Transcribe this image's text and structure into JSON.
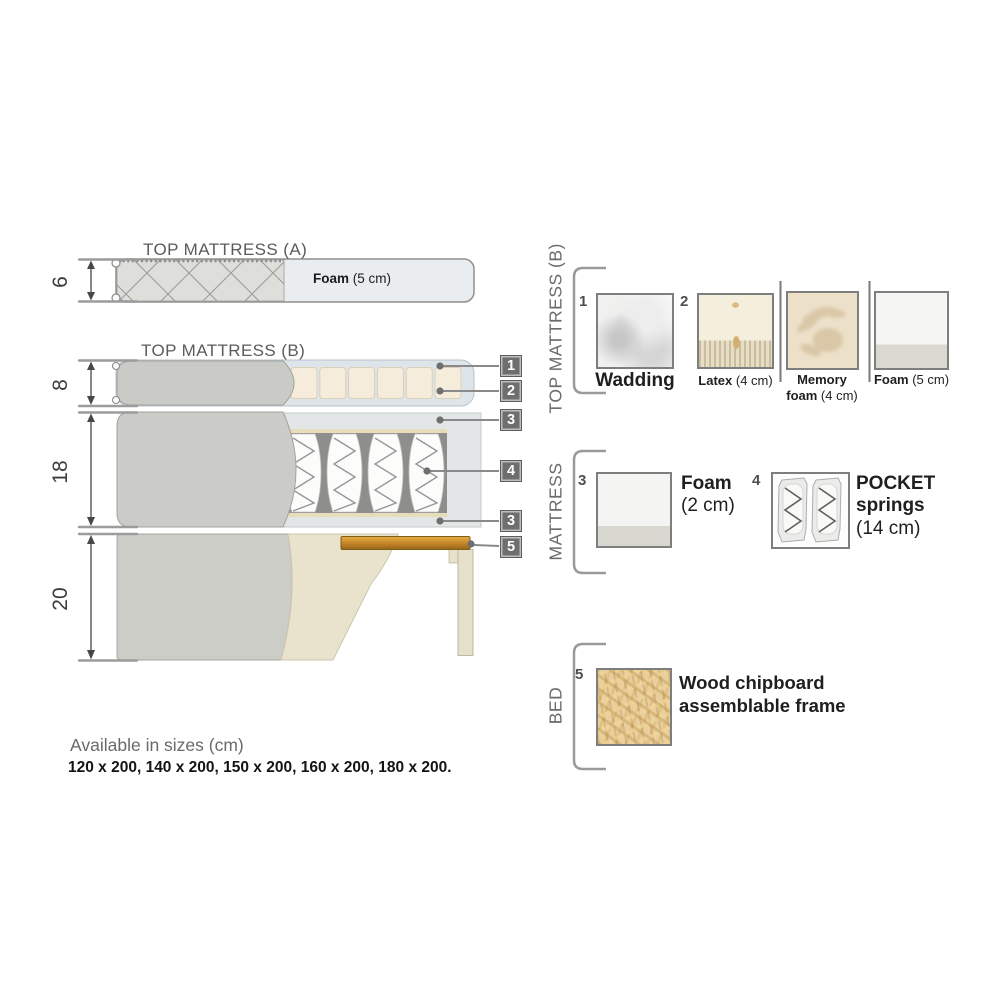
{
  "diagram": {
    "top_a": {
      "title": "TOP MATTRESS (A)"
    },
    "top_b": {
      "title": "TOP MATTRESS (B)"
    },
    "foam": {
      "bold": "Foam",
      "rest": " (5 cm)"
    },
    "dims": [
      "6",
      "8",
      "18",
      "20"
    ],
    "badges": [
      "1",
      "2",
      "3",
      "4",
      "3",
      "5"
    ]
  },
  "legend": {
    "sections": [
      {
        "label": "TOP MATTRESS (B)",
        "items": [
          {
            "num": "1",
            "bold": "Wadding",
            "rest": ""
          },
          {
            "num": "2",
            "bold": "Latex",
            "rest": " (4 cm)"
          },
          {
            "bold": "Memory foam",
            "rest": " (4 cm)"
          },
          {
            "bold": "Foam",
            "rest": " (5 cm)"
          }
        ]
      },
      {
        "label": "MATTRESS",
        "items": [
          {
            "num": "3",
            "bold": "Foam",
            "rest": "(2 cm)"
          },
          {
            "num": "4",
            "bold": "POCKET springs",
            "rest": "(14 cm)"
          }
        ]
      },
      {
        "label": "BED",
        "items": [
          {
            "num": "5",
            "bold": "Wood chipboard assemblable frame",
            "rest": ""
          }
        ]
      }
    ]
  },
  "footer": {
    "title": "Available in sizes (cm)",
    "sizes": "120 x 200, 140 x 200, 150 x 200, 160 x 200, 180 x 200."
  },
  "colors": {
    "badge_gray": "#6e6e6e",
    "fabric_gray": "#cacac6",
    "wadding_blue": "#dde5eb",
    "latex_beige": "#f6ecdb",
    "wood_orange": "#c8872a",
    "callout_line": "#8a8a8a"
  }
}
